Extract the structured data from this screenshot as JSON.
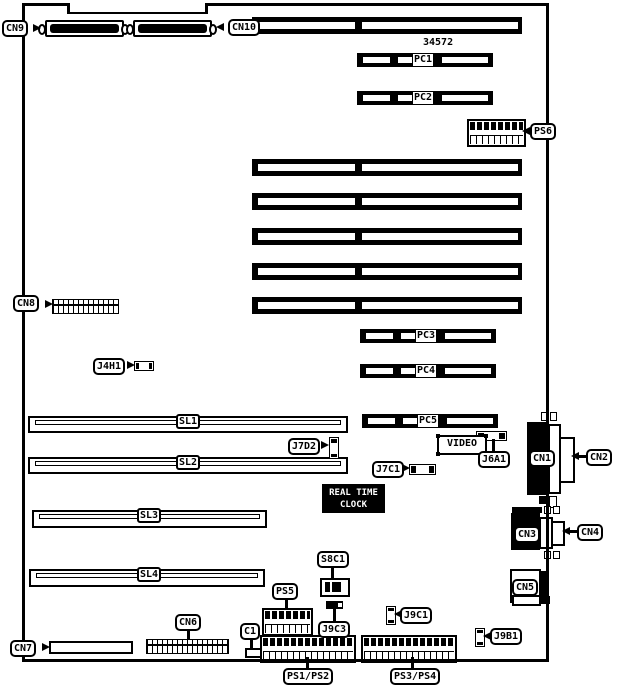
{
  "part_number": "34572",
  "rtc": {
    "line1": "REAL TIME",
    "line2": "CLOCK"
  },
  "labels": {
    "cn1": "CN1",
    "cn2": "CN2",
    "cn3": "CN3",
    "cn4": "CN4",
    "cn5": "CN5",
    "cn6": "CN6",
    "cn7": "CN7",
    "cn8": "CN8",
    "cn9": "CN9",
    "cn10": "CN10",
    "pc1": "PC1",
    "pc2": "PC2",
    "pc3": "PC3",
    "pc4": "PC4",
    "pc5": "PC5",
    "sl1": "SL1",
    "sl2": "SL2",
    "sl3": "SL3",
    "sl4": "SL4",
    "ps5": "PS5",
    "ps6": "PS6",
    "ps12": "PS1/PS2",
    "ps34": "PS3/PS4",
    "j4h1": "J4H1",
    "j7d2": "J7D2",
    "j7c1": "J7C1",
    "j6a1": "J6A1",
    "j9c3": "J9C3",
    "j9c1": "J9C1",
    "j9b1": "J9B1",
    "s8c1": "S8C1",
    "c1": "C1",
    "video": "VIDEO"
  },
  "colors": {
    "ink": "#000000",
    "paper": "#ffffff"
  }
}
